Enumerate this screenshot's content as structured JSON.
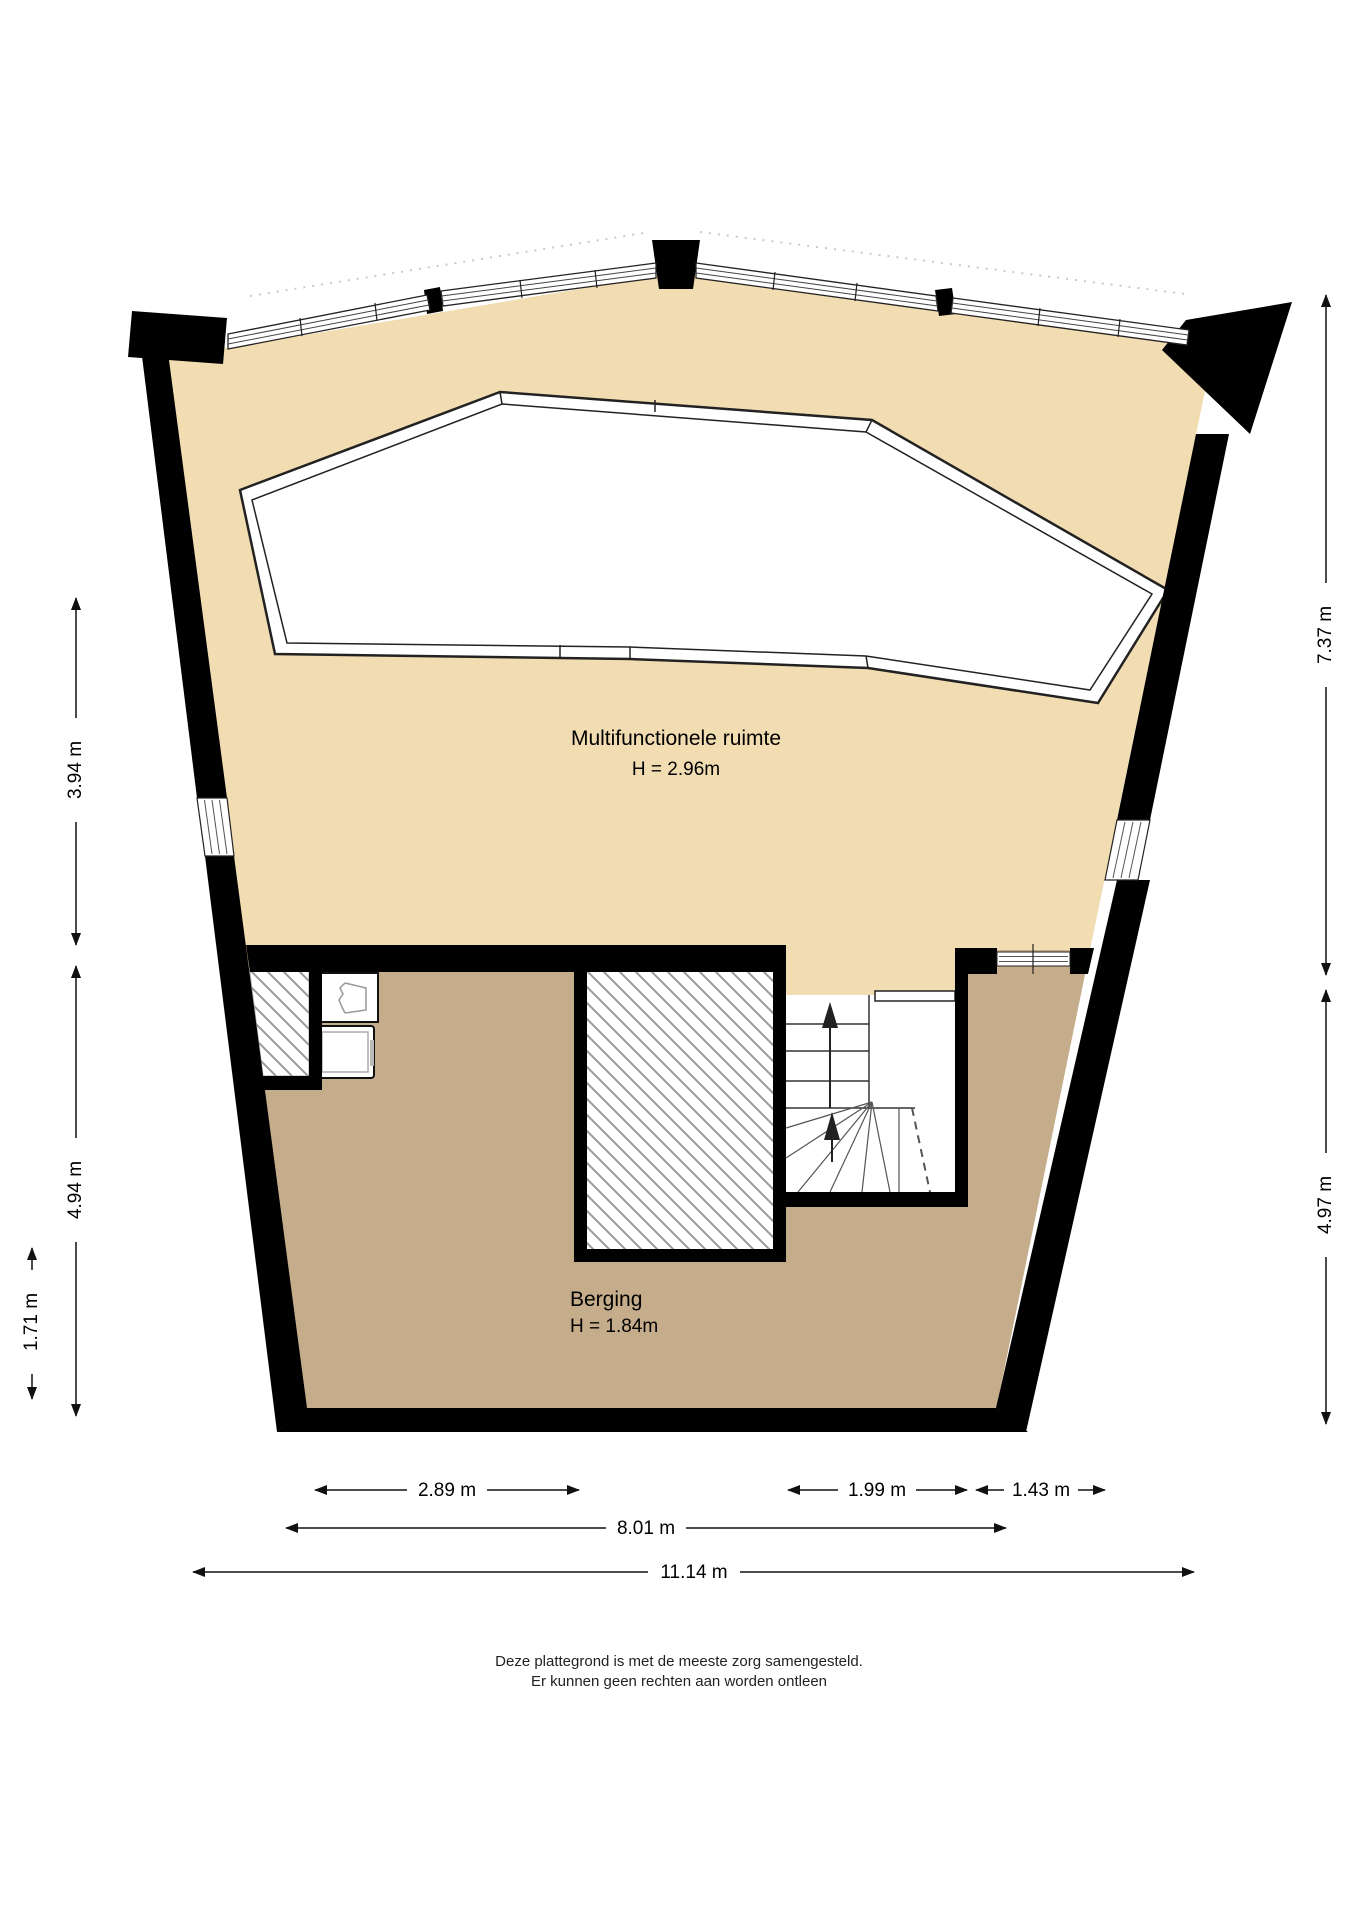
{
  "plan": {
    "title": "floor-plan",
    "rooms": [
      {
        "name": "Multifunctionele ruimte",
        "height_label": "H = 2.96m"
      },
      {
        "name": "Berging",
        "height_label": "H = 1.84m"
      }
    ],
    "colors": {
      "upper_floor": "#f2dcb2",
      "lower_floor": "#c5ad8b",
      "wall": "#000000",
      "hatch": "#999999",
      "rim": "#222222"
    }
  },
  "dimensions": {
    "left": [
      {
        "label": "3.94 m"
      },
      {
        "label": "4.94 m"
      },
      {
        "label": "1.71 m"
      }
    ],
    "right": [
      {
        "label": "7.37 m"
      },
      {
        "label": "4.97 m"
      }
    ],
    "bottom": [
      {
        "label": "2.89 m"
      },
      {
        "label": "1.99 m"
      },
      {
        "label": "1.43 m"
      },
      {
        "label": "8.01 m"
      },
      {
        "label": "11.14 m"
      }
    ]
  },
  "footer": {
    "line1": "Deze plattegrond is met de meeste zorg samengesteld.",
    "line2": "Er kunnen geen rechten aan worden ontleen"
  }
}
